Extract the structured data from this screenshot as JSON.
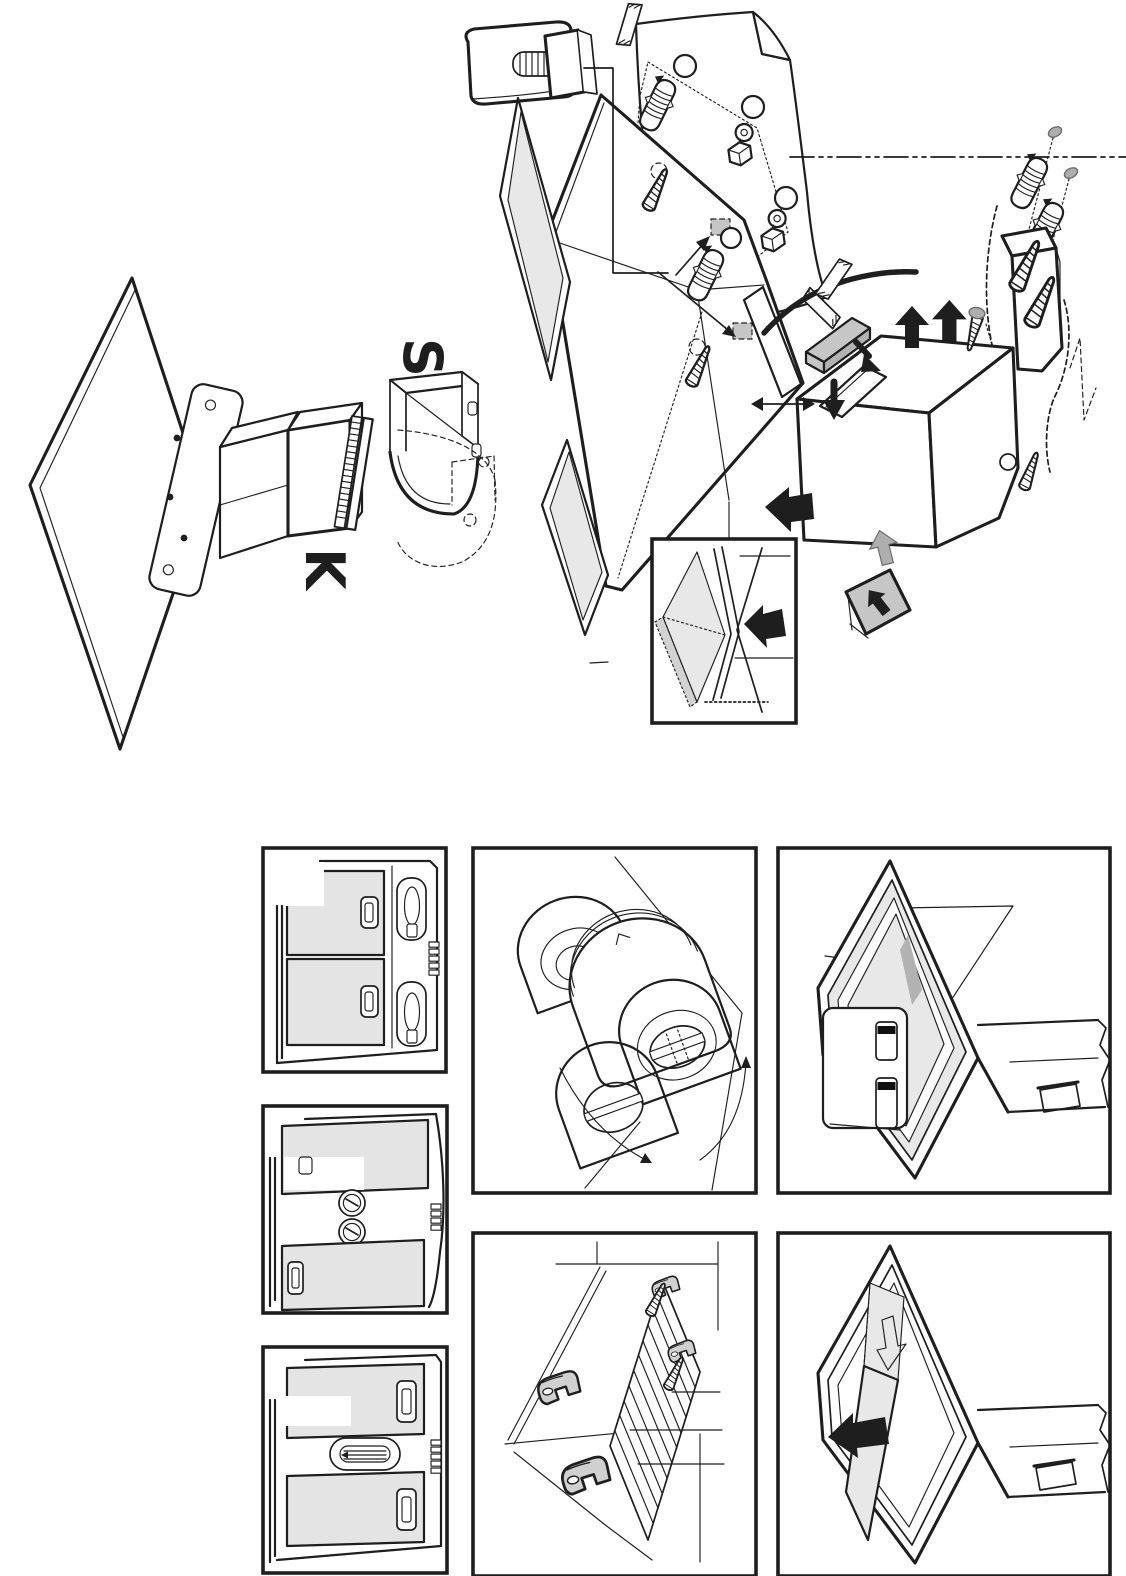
{
  "document": {
    "kind": "appliance installation diagram page",
    "background": "#ffffff",
    "visible_text": [
      "S",
      "K"
    ]
  },
  "labels": {
    "elbow_part": "S",
    "adapter_part": "K"
  },
  "colors": {
    "ink": "#1e1e1e",
    "white": "#ffffff",
    "glass": "#e8e8e8",
    "glass_edge": "#d2d2d2",
    "filter": "#e4e4e4",
    "plate": "#c6c6c6",
    "plate_dark": "#b2b2b2",
    "dome_light": "#d9d9d9",
    "dome_mid": "#c7c7c7",
    "dome_dark": "#989898",
    "clip": "#d0d0d0",
    "arrow_gray": "#aeaeae",
    "latch": "#111111"
  },
  "figures": {
    "exploded_view": {
      "name": "wall mounting exploded view",
      "parts": [
        "wall-spacer-plate-with-bolt",
        "drilling-template-sheet",
        "adhesive-tape-strips",
        "hood-canopy",
        "visor-glass-panels",
        "wall-anchors",
        "mounting-screws",
        "keyhole-brackets",
        "center-dash-dot-line",
        "mounting-bracket",
        "hood-body-box",
        "cover-plate",
        "power-cable",
        "charcoal-filter",
        "direction-arrows",
        "glass-insert-detail-inset"
      ]
    },
    "duct_assembly": {
      "name": "duct adapter and elbow assembly",
      "parts": [
        "wall-panel",
        "flange-plate",
        "duct-funnel-K",
        "seal-strip",
        "duct-elbow-S",
        "rotated-position-ghost"
      ]
    },
    "panels": [
      {
        "id": "panel-underside-filters",
        "name": "underside view: two grease filters and two lamps"
      },
      {
        "id": "panel-underside-knobs",
        "name": "underside view: two rotary lamp fittings"
      },
      {
        "id": "panel-underside-lamp",
        "name": "underside view: central oval lamp lens"
      },
      {
        "id": "panel-blower-rotation",
        "name": "blower outlet rotation detail"
      },
      {
        "id": "panel-cabinet-clips",
        "name": "cabinet base with grille and fixing clips"
      },
      {
        "id": "panel-front-door-open",
        "name": "hood with filter access door opened"
      },
      {
        "id": "panel-glass-slide-out",
        "name": "hood with glass panel sliding out"
      }
    ]
  }
}
